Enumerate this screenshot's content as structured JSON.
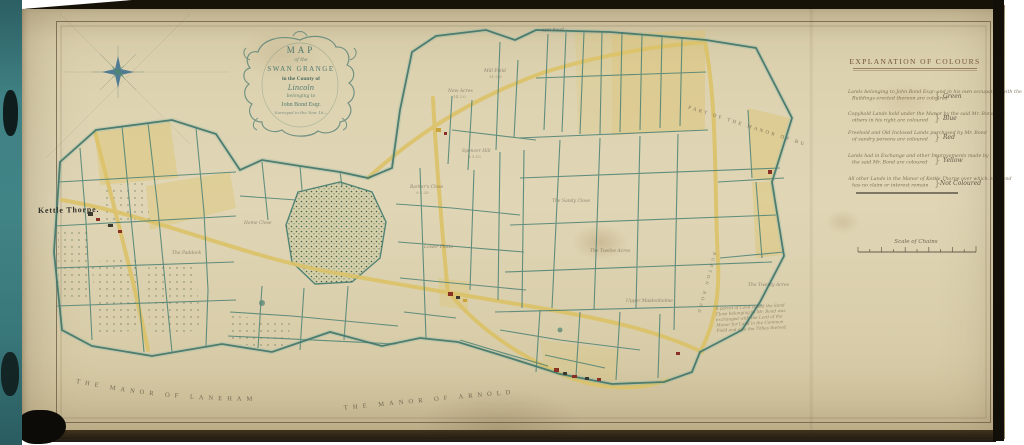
{
  "colors": {
    "paper": "#d9cda9",
    "field_ink": "#4c8174",
    "road_yellow": "#dcc268",
    "building_red": "#8a2f23",
    "binding_teal": "#3c7e80",
    "frame_line": "#6b5c44"
  },
  "icons": {
    "compass": "compass-rose-icon"
  },
  "cartouche": {
    "lines": [
      "MAP",
      "of the",
      "SWAN GRANGE",
      "in the County of",
      "Lincoln",
      "belonging to",
      "John Bond Esqr.",
      "Surveyed in the Year 18—"
    ]
  },
  "legend": {
    "heading": "EXPLANATION OF COLOURS",
    "rows": [
      {
        "line1": "Lands belonging to John Bond Esqr. and in his own occupation with the",
        "line2": "Buildings erected thereon are coloured",
        "color": "Green"
      },
      {
        "line1": "Copyhold Lands held under the Manor by the said Mr. Bond and",
        "line2": "others in his right are coloured",
        "color": "Blue"
      },
      {
        "line1": "Freehold and Old Inclosed Lands purchased by Mr. Bond",
        "line2": "of sundry persons are coloured",
        "color": "Red"
      },
      {
        "line1": "Lands had in Exchange and other Improvements made by",
        "line2": "the said Mr. Bond are coloured",
        "color": "Yellow"
      },
      {
        "line1": "All other Lands in the Manor of Kettle Thorpe over which Mr. Bond",
        "line2": "has no claim or interest remain",
        "color": "Not Coloured"
      }
    ]
  },
  "scale": {
    "label": "Scale of Chains"
  },
  "labels": {
    "village": "Kettle Thorpe.",
    "arc_left": "THE MANOR OF LANEHAM",
    "arc_right": "THE MANOR OF ARNOLD",
    "diag_right": "PART OF THE MANOR OF BURTON",
    "road_diag": "BURTON ROAD",
    "mill_road": "Mill Road"
  },
  "note": {
    "lines": [
      "A parcel of Land called the Sand",
      "Close belonging to Mr. Bond was",
      "exchanged with the Lord of the",
      "Manor for Land in the Common",
      "Field and also the Tithes thereof."
    ]
  },
  "fields": [
    {
      "name": "New Acres",
      "area": "14.2.0"
    },
    {
      "name": "Mill Field",
      "area": "31.0.5"
    },
    {
      "name": "Spencer Hill",
      "area": "8.3.10"
    },
    {
      "name": "Barker's Close",
      "area": "9.1.20"
    },
    {
      "name": "The Sandy Close"
    },
    {
      "name": "Lower Platts"
    },
    {
      "name": "The Twelve Acres"
    },
    {
      "name": "Upper Maidenholme"
    },
    {
      "name": "Home Close"
    },
    {
      "name": "The Twenty Acres"
    },
    {
      "name": "The Paddock"
    }
  ]
}
